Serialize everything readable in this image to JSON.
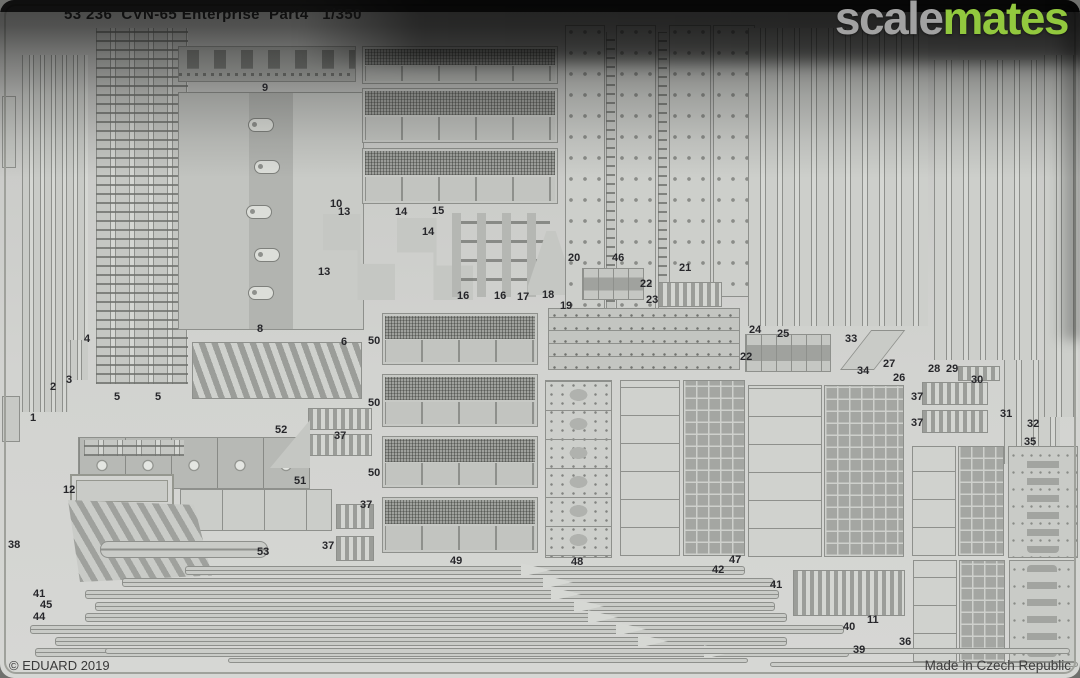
{
  "sheet": {
    "title": "53 236  CVN-65 Enterprise  Part4   1/350",
    "product_code": "53 236",
    "subject": "CVN-65 Enterprise",
    "part_name": "Part4",
    "scale": "1/350"
  },
  "watermark": {
    "gray_text": "scale",
    "green_text": "mates",
    "gray_color": "#a2a2a2",
    "green_color": "#92c83e"
  },
  "footer": {
    "copyright": "© EDUARD 2019",
    "origin": "Made in Czech Republic"
  },
  "colors": {
    "sheet_base": "#d2d3d0",
    "part_fill": "#c7c9c5",
    "etch_line": "#8e908c",
    "top_shadow": "#111111"
  },
  "part_labels": [
    {
      "n": "1",
      "x": 30,
      "y": 412
    },
    {
      "n": "2",
      "x": 50,
      "y": 381
    },
    {
      "n": "3",
      "x": 66,
      "y": 374
    },
    {
      "n": "4",
      "x": 84,
      "y": 333
    },
    {
      "n": "5",
      "x": 114,
      "y": 391
    },
    {
      "n": "5",
      "x": 155,
      "y": 391
    },
    {
      "n": "8",
      "x": 257,
      "y": 323
    },
    {
      "n": "6",
      "x": 341,
      "y": 336
    },
    {
      "n": "9",
      "x": 262,
      "y": 82
    },
    {
      "n": "10",
      "x": 330,
      "y": 198
    },
    {
      "n": "13",
      "x": 338,
      "y": 206
    },
    {
      "n": "14",
      "x": 395,
      "y": 206
    },
    {
      "n": "15",
      "x": 432,
      "y": 205
    },
    {
      "n": "14",
      "x": 422,
      "y": 226
    },
    {
      "n": "13",
      "x": 318,
      "y": 266
    },
    {
      "n": "16",
      "x": 457,
      "y": 290
    },
    {
      "n": "16",
      "x": 494,
      "y": 290
    },
    {
      "n": "17",
      "x": 517,
      "y": 291
    },
    {
      "n": "18",
      "x": 542,
      "y": 289
    },
    {
      "n": "19",
      "x": 560,
      "y": 300
    },
    {
      "n": "20",
      "x": 568,
      "y": 252
    },
    {
      "n": "46",
      "x": 612,
      "y": 252
    },
    {
      "n": "21",
      "x": 679,
      "y": 262
    },
    {
      "n": "22",
      "x": 640,
      "y": 278
    },
    {
      "n": "23",
      "x": 646,
      "y": 294
    },
    {
      "n": "24",
      "x": 749,
      "y": 324
    },
    {
      "n": "25",
      "x": 777,
      "y": 328
    },
    {
      "n": "33",
      "x": 845,
      "y": 333
    },
    {
      "n": "34",
      "x": 857,
      "y": 365
    },
    {
      "n": "27",
      "x": 883,
      "y": 358
    },
    {
      "n": "28",
      "x": 928,
      "y": 363
    },
    {
      "n": "29",
      "x": 946,
      "y": 363
    },
    {
      "n": "30",
      "x": 971,
      "y": 374
    },
    {
      "n": "26",
      "x": 893,
      "y": 372
    },
    {
      "n": "22",
      "x": 740,
      "y": 351
    },
    {
      "n": "31",
      "x": 1000,
      "y": 408
    },
    {
      "n": "32",
      "x": 1027,
      "y": 418
    },
    {
      "n": "35",
      "x": 1024,
      "y": 436
    },
    {
      "n": "37",
      "x": 911,
      "y": 391
    },
    {
      "n": "37",
      "x": 911,
      "y": 417
    },
    {
      "n": "12",
      "x": 63,
      "y": 484
    },
    {
      "n": "38",
      "x": 8,
      "y": 539
    },
    {
      "n": "52",
      "x": 275,
      "y": 424
    },
    {
      "n": "51",
      "x": 294,
      "y": 475
    },
    {
      "n": "53",
      "x": 257,
      "y": 546
    },
    {
      "n": "37",
      "x": 334,
      "y": 430
    },
    {
      "n": "37",
      "x": 360,
      "y": 499
    },
    {
      "n": "37",
      "x": 322,
      "y": 540
    },
    {
      "n": "50",
      "x": 368,
      "y": 335
    },
    {
      "n": "50",
      "x": 368,
      "y": 397
    },
    {
      "n": "50",
      "x": 368,
      "y": 467
    },
    {
      "n": "49",
      "x": 450,
      "y": 555
    },
    {
      "n": "48",
      "x": 571,
      "y": 556
    },
    {
      "n": "47",
      "x": 729,
      "y": 554
    },
    {
      "n": "42",
      "x": 712,
      "y": 564
    },
    {
      "n": "41",
      "x": 770,
      "y": 579
    },
    {
      "n": "41",
      "x": 33,
      "y": 588
    },
    {
      "n": "45",
      "x": 40,
      "y": 599
    },
    {
      "n": "44",
      "x": 33,
      "y": 611
    },
    {
      "n": "40",
      "x": 843,
      "y": 621
    },
    {
      "n": "39",
      "x": 853,
      "y": 644
    },
    {
      "n": "11",
      "x": 867,
      "y": 614
    },
    {
      "n": "36",
      "x": 899,
      "y": 636
    }
  ]
}
